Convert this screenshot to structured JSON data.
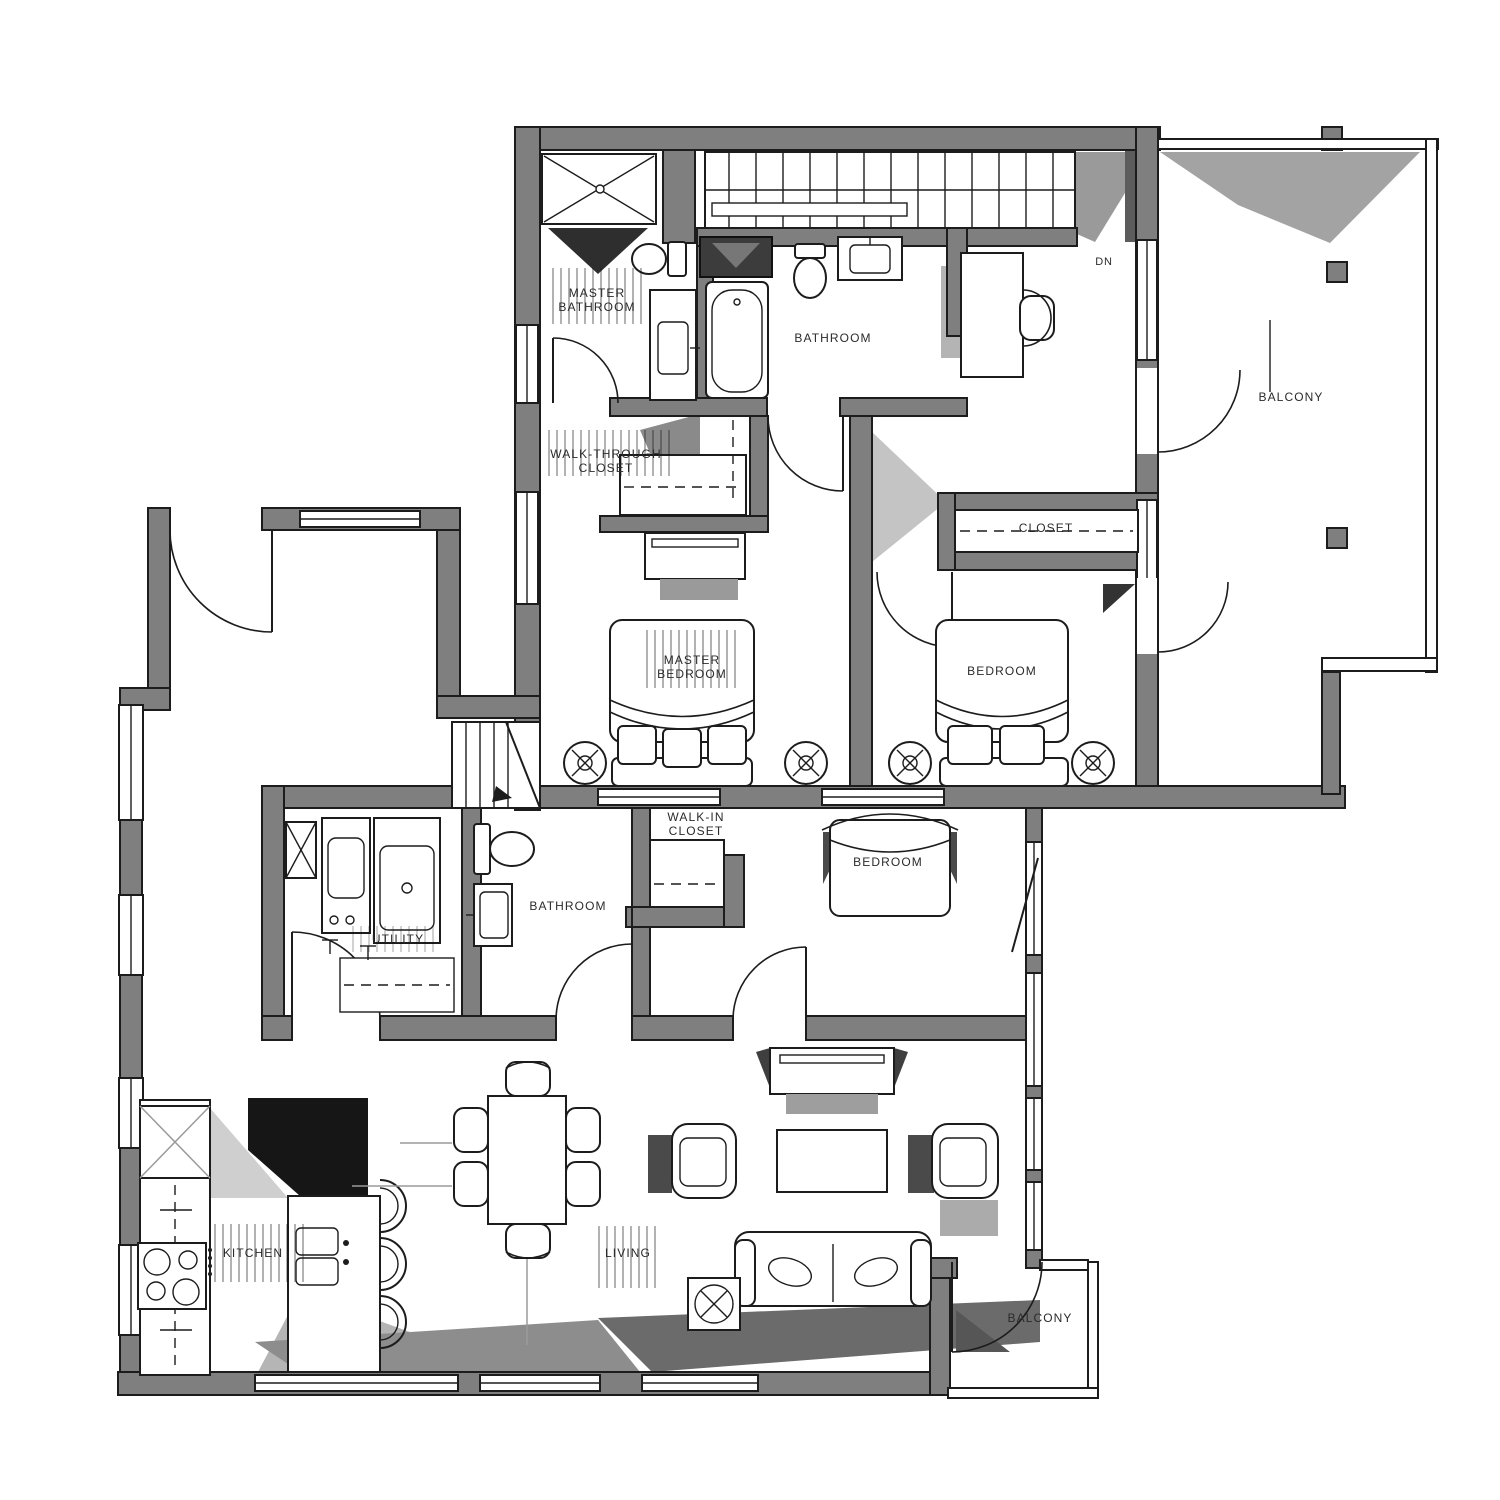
{
  "diagram": {
    "type": "floor-plan",
    "description": "Two-storey apartment floor plan, black/grey architectural drawing",
    "floors": [
      {
        "name": "upper-floor",
        "rooms": [
          "MASTER BATHROOM",
          "BATHROOM",
          "WALK-THROUGH CLOSET",
          "MASTER BEDROOM",
          "BEDROOM",
          "CLOSET",
          "BALCONY"
        ],
        "annotations": [
          "DN"
        ]
      },
      {
        "name": "lower-floor",
        "rooms": [
          "UTILITY",
          "BATHROOM",
          "WALK-IN CLOSET",
          "BEDROOM",
          "KITCHEN",
          "LIVING",
          "BALCONY"
        ]
      }
    ]
  },
  "colors": {
    "wall_fill": "#7f7f7f",
    "line": "#1c1c1c",
    "shadow": "#9a9a9a",
    "paper": "#ffffff"
  },
  "labels": {
    "up_master_bath_1": "MASTER",
    "up_master_bath_2": "BATHROOM",
    "up_bathroom": "BATHROOM",
    "up_wtc_1": "WALK-THROUGH",
    "up_wtc_2": "CLOSET",
    "up_master_bed_1": "MASTER",
    "up_master_bed_2": "BEDROOM",
    "up_bedroom": "BEDROOM",
    "up_closet": "CLOSET",
    "up_dn": "DN",
    "up_balcony": "BALCONY",
    "lo_utility": "UTILITY",
    "lo_bathroom": "BATHROOM",
    "lo_wic_1": "WALK-IN",
    "lo_wic_2": "CLOSET",
    "lo_bedroom": "BEDROOM",
    "lo_kitchen": "KITCHEN",
    "lo_living": "LIVING",
    "lo_balcony": "BALCONY"
  }
}
